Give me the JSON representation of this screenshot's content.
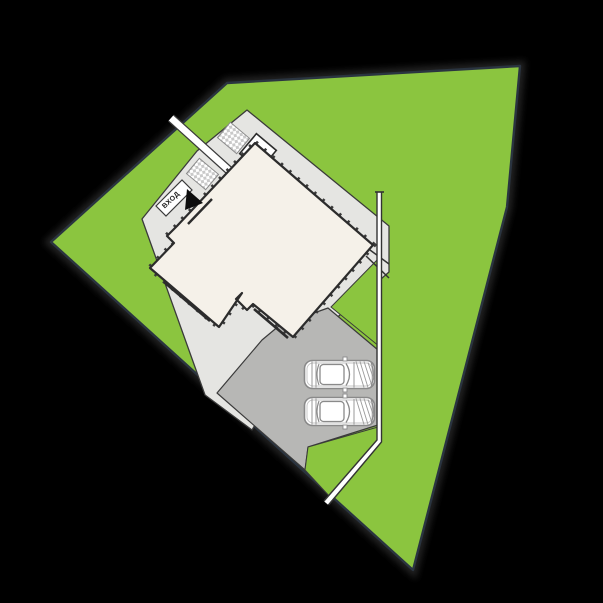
{
  "site_plan": {
    "entrance_label": "ВХОД",
    "vehicle_count": "2",
    "colors": {
      "background": "#000000",
      "lawn": "#8bc53f",
      "lot_outline": "#2a3440",
      "terrace": "#e5e5e2",
      "walkway": "#ffffff",
      "building": "#f5f1e9",
      "wall_outline": "#2c2c2c",
      "driveway": "#b7b7b5",
      "stairs_check": "#c9c9c9",
      "car_outline": "#8a8a8a",
      "fence": "#333333",
      "entrance_arrow": "#0d0d0d"
    }
  }
}
